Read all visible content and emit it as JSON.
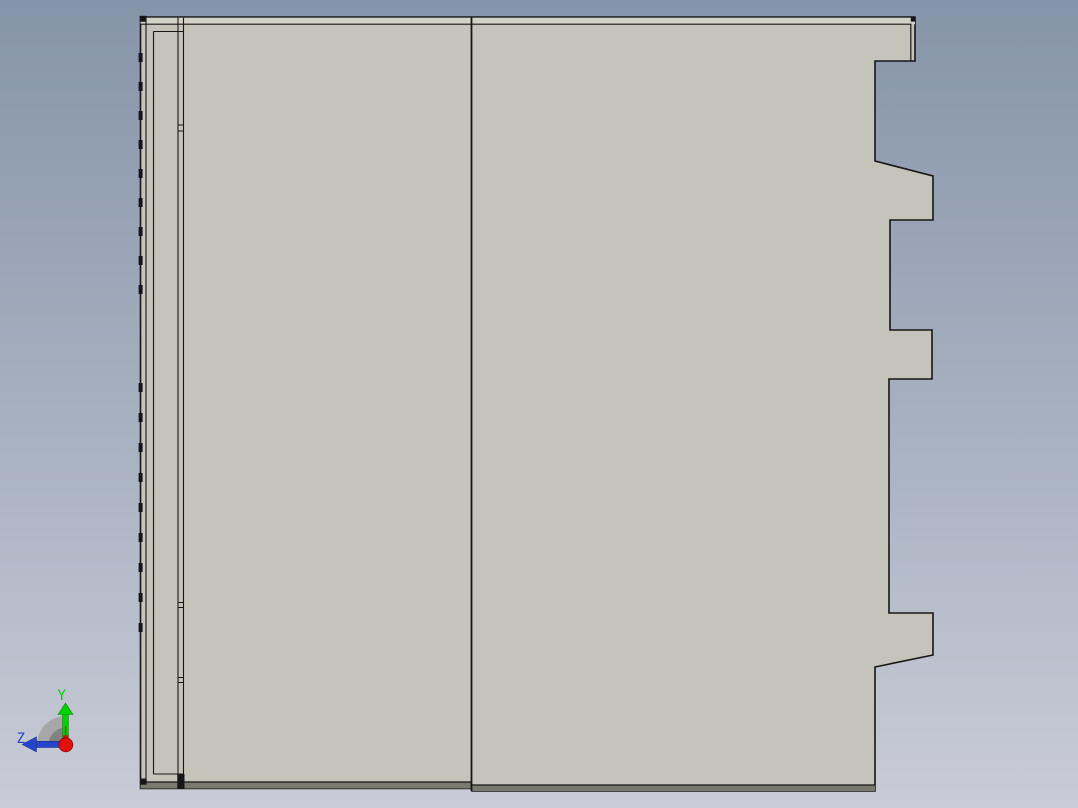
{
  "app": {
    "view_name": "cad-part-side-view"
  },
  "triad": {
    "y_label": "Y",
    "z_label": "Z"
  },
  "colors": {
    "bg_top": "#8694a9",
    "bg_mid": "#a9b2c2",
    "bg_bottom": "#c9ccd7",
    "part_fill": "#c5c4ba",
    "top_chamfer": "#d3d2c9",
    "bottom_chamfer": "#79796f",
    "edge": "#161616",
    "tick": "#14141e",
    "axis_y_green": "#00d200",
    "axis_y_dark": "#0a8a0a",
    "axis_z_blue": "#2445cc",
    "axis_z_dark": "#132a7a",
    "axis_x_red": "#e41010",
    "axis_x_dark": "#8a0606",
    "fan_outer": "#a7a7a7",
    "fan_inner": "#828282"
  },
  "geometry": {
    "shapes": [
      {
        "type": "polygon",
        "name": "part-body-outline",
        "points": [
          [
            140.5,
            17
          ],
          [
            915,
            17
          ],
          [
            915,
            61
          ],
          [
            875,
            61
          ],
          [
            875,
            161
          ],
          [
            933,
            176
          ],
          [
            933,
            220
          ],
          [
            890,
            220
          ],
          [
            890,
            330
          ],
          [
            932,
            330
          ],
          [
            932,
            379
          ],
          [
            889,
            379
          ],
          [
            889,
            613
          ],
          [
            933,
            613
          ],
          [
            933,
            655
          ],
          [
            875,
            667
          ],
          [
            875,
            791
          ],
          [
            472,
            791
          ],
          [
            472,
            788.5
          ],
          [
            140.5,
            788.5
          ]
        ],
        "fill": "$part_fill",
        "stroke": "$edge",
        "sw": 1.6
      },
      {
        "type": "rect",
        "name": "top-chamfer-band",
        "x": 140.5,
        "y": 17.8,
        "w": 774.5,
        "h": 6.4,
        "fill": "$top_chamfer"
      },
      {
        "type": "polyline",
        "name": "top-chamfer-inner-line",
        "points": [
          [
            140.5,
            24.2
          ],
          [
            910.8,
            24.2
          ],
          [
            910.8,
            61
          ]
        ],
        "stroke": "$edge",
        "sw": 1.2
      },
      {
        "type": "rect",
        "name": "bottom-chamfer-band-left",
        "x": 140.5,
        "y": 782,
        "w": 331.5,
        "h": 6.5,
        "fill": "$bottom_chamfer"
      },
      {
        "type": "line",
        "name": "bottom-chamfer-line-left",
        "x1": 140.5,
        "y1": 782,
        "x2": 472,
        "y2": 782,
        "stroke": "$edge",
        "sw": 1.2
      },
      {
        "type": "rect",
        "name": "bottom-chamfer-band-right",
        "x": 472,
        "y": 785,
        "w": 403,
        "h": 6,
        "fill": "$bottom_chamfer"
      },
      {
        "type": "line",
        "name": "bottom-chamfer-line-right",
        "x1": 472,
        "y1": 785,
        "x2": 875,
        "y2": 785,
        "stroke": "$edge",
        "sw": 1.2
      },
      {
        "type": "line",
        "name": "center-divider-edge",
        "x1": 471.5,
        "y1": 17,
        "x2": 471.5,
        "y2": 791,
        "stroke": "$edge",
        "sw": 1.8
      },
      {
        "type": "line",
        "name": "left-strip-inner-edge",
        "x1": 146,
        "y1": 17.8,
        "x2": 146,
        "y2": 782,
        "stroke": "$edge",
        "sw": 1.1
      },
      {
        "type": "line",
        "name": "left-panel-left-edge",
        "x1": 153.5,
        "y1": 31.5,
        "x2": 153.5,
        "y2": 774,
        "stroke": "$edge",
        "sw": 1.1
      },
      {
        "type": "line",
        "name": "left-panel-top-edge",
        "x1": 153.5,
        "y1": 31.5,
        "x2": 183.5,
        "y2": 31.5,
        "stroke": "$edge",
        "sw": 1.1
      },
      {
        "type": "line",
        "name": "left-panel-bottom-edge",
        "x1": 153.5,
        "y1": 774,
        "x2": 183.5,
        "y2": 774,
        "stroke": "$edge",
        "sw": 1.1
      },
      {
        "type": "line",
        "name": "flange-left-edge",
        "x1": 178,
        "y1": 17.8,
        "x2": 178,
        "y2": 782,
        "stroke": "$edge",
        "sw": 1.1
      },
      {
        "type": "line",
        "name": "flange-right-edge",
        "x1": 183.5,
        "y1": 17.8,
        "x2": 183.5,
        "y2": 782,
        "stroke": "$edge",
        "sw": 1.1
      },
      {
        "type": "rect",
        "name": "flange-joint-1",
        "x": 178,
        "y": 125,
        "w": 5.5,
        "h": 6,
        "stroke": "$edge",
        "sw": 1,
        "fill": "none"
      },
      {
        "type": "rect",
        "name": "flange-joint-2",
        "x": 178,
        "y": 602.5,
        "w": 5.5,
        "h": 5,
        "stroke": "$edge",
        "sw": 1,
        "fill": "none"
      },
      {
        "type": "rect",
        "name": "flange-joint-3",
        "x": 178,
        "y": 677.5,
        "w": 5.5,
        "h": 5,
        "stroke": "$edge",
        "sw": 1,
        "fill": "none"
      },
      {
        "type": "rect",
        "name": "flange-bottom-fill",
        "x": 177.3,
        "y": 774,
        "w": 7.2,
        "h": 14.5,
        "fill": "$edge"
      },
      {
        "type": "rect",
        "name": "corner-marker-top-left",
        "x": 139.8,
        "y": 15.8,
        "w": 6.6,
        "h": 6,
        "fill": "$edge"
      },
      {
        "type": "rect",
        "name": "corner-marker-bottom-left",
        "x": 140,
        "y": 778.5,
        "w": 6.6,
        "h": 6.2,
        "fill": "$edge"
      },
      {
        "type": "rect",
        "name": "corner-marker-top-right",
        "x": 910.8,
        "y": 17,
        "w": 4.8,
        "h": 4.6,
        "fill": "$edge"
      },
      {
        "type": "ticks",
        "name": "left-edge-tab-marks",
        "x": 138.6,
        "w": 4,
        "h": 9,
        "fill": "$tick",
        "ys": [
          53,
          82,
          111,
          140,
          169,
          198,
          227,
          256,
          285,
          383,
          413,
          443,
          473,
          503,
          533,
          563,
          593,
          623
        ]
      }
    ]
  }
}
